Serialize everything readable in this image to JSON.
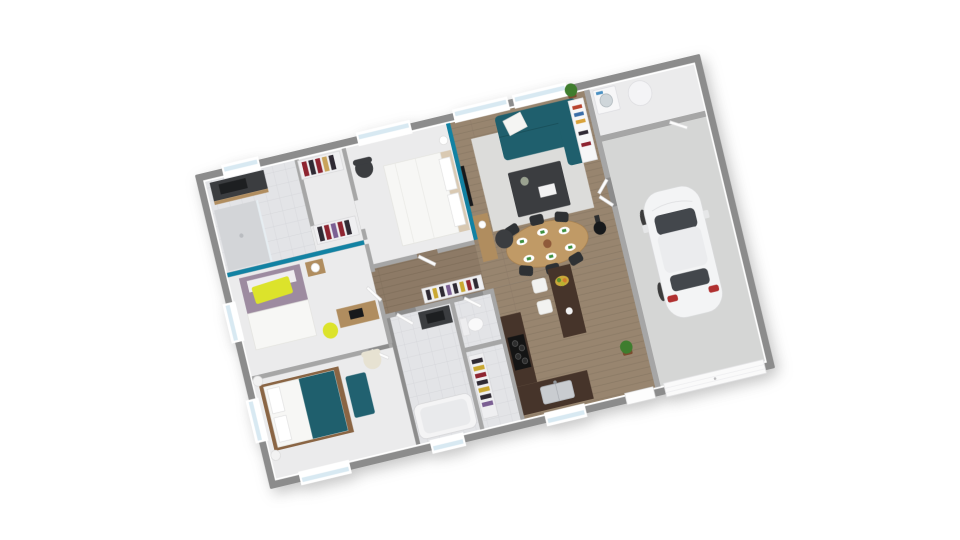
{
  "scene": {
    "description": "3D rendered top-down floor plan of a single-storey house with garage, viewed from above at a slight rotation",
    "background": "#ffffff",
    "rotation_deg": -13.5
  },
  "palette": {
    "exterior_wall": "#8c8c8c",
    "interior_wall": "#a6a6a6",
    "wall_face": "#ffffff",
    "bedroom_floor": "#ebebec",
    "tile_floor": "#e3e4e7",
    "shower_floor": "#d3d5d8",
    "garage_floor": "#d5d6d5",
    "rug": "#dcdcda",
    "teal_wall": "#1282a3",
    "teal_sofa": "#1f5f6d",
    "teal_bench": "#216170",
    "teal_blanket": "#1f5f6d",
    "yellow": "#dce32b",
    "counter_dark": "#46342a",
    "dining_wood": "#c09a66",
    "sideboard_wood": "#b08d5f",
    "bed_wood": "#8a6544",
    "mauve_bedding": "#9d8ba0",
    "white_furniture": "#f6f6f7",
    "dark_furniture": "#3b3d40",
    "black": "#17191b",
    "chair_black": "#2e3134",
    "plant_green": "#3f7d2e",
    "pot_brown": "#7a4b2e",
    "napkin_green": "#3e8f3e",
    "window_glass": "#d8e9f2",
    "window_frame": "#ffffff",
    "car_body": "#f3f4f5",
    "car_glass": "#43474c",
    "taillight_red": "#b03030",
    "stainless": "#c9ccd0",
    "cream": "#e7e2d2",
    "wood_floor": "#98856f",
    "hall_wood_floor": "#8d7a66"
  },
  "rooms": [
    {
      "name": "bathroom-1",
      "floor": "tile",
      "furniture": [
        "dark-vanity-sink",
        "walk-in-shower"
      ]
    },
    {
      "name": "closet",
      "floor": "light",
      "furniture": [
        "open-wardrobe-red-clothes",
        "open-wardrobe-red-clothes-2"
      ]
    },
    {
      "name": "master-bedroom",
      "floor": "light",
      "furniture": [
        "double-bed-white",
        "dark-armchair",
        "bedside-lamp"
      ],
      "accent_wall": "teal east wall with TV"
    },
    {
      "name": "bedroom-2",
      "floor": "light",
      "furniture": [
        "bed-mauve-yellow-pillow",
        "nightstand-lamp",
        "desk",
        "yellow-chair"
      ],
      "accent_wall": "teal north wall"
    },
    {
      "name": "bedroom-3",
      "floor": "light",
      "furniture": [
        "wood-bed-teal-blanket",
        "teal-bench",
        "cream-armchair",
        "ball-lamp-1",
        "ball-lamp-2"
      ]
    },
    {
      "name": "hallway",
      "floor": "wood",
      "furniture": [
        "wardrobe-clothes"
      ]
    },
    {
      "name": "bathroom-2",
      "floor": "tile",
      "furniture": [
        "bathtub",
        "dark-vanity-sink",
        "wardrobe-clothes"
      ]
    },
    {
      "name": "wc",
      "floor": "tile",
      "furniture": [
        "toilet"
      ]
    },
    {
      "name": "living-room",
      "floor": "wood",
      "furniture": [
        "teal-sofa",
        "white-cushion",
        "coffee-table-dark",
        "light-rug",
        "oval-dining-table",
        "six-black-chairs",
        "place-settings",
        "tv-on-teal-wall",
        "wood-sideboard",
        "dark-pouf",
        "white-bookshelf",
        "potted-plant",
        "wood-stove"
      ]
    },
    {
      "name": "kitchen",
      "floor": "wood",
      "furniture": [
        "l-shaped-dark-counter",
        "cooktop",
        "double-sink",
        "island-dark",
        "fruit-bowl",
        "two-white-stools",
        "floor-plant"
      ]
    },
    {
      "name": "laundry",
      "floor": "light",
      "furniture": [
        "washing-machine",
        "water-heater-cylinder"
      ]
    },
    {
      "name": "garage",
      "floor": "concrete",
      "furniture": [
        "white-hatchback-car",
        "garage-door"
      ]
    }
  ],
  "openings": {
    "windows": [
      "bathroom-1-north",
      "master-bedroom-north",
      "living-north-1",
      "living-north-2",
      "bedroom-2-west",
      "bedroom-3-west",
      "bedroom-3-south",
      "bathroom-2-south",
      "kitchen-south"
    ],
    "doors": [
      "bathroom-1-door",
      "closet-opening",
      "master-bedroom-door",
      "bedroom-2-door",
      "bedroom-3-door",
      "bathroom-2-door",
      "wc-door",
      "entry-double-doors",
      "laundry-garage-door",
      "front-entry-door",
      "garage-sectional-door"
    ]
  },
  "dining": {
    "seats": 6,
    "plates": 6
  },
  "car": {
    "type": "hatchback",
    "color": "white",
    "orientation": "nose toward north wall"
  }
}
